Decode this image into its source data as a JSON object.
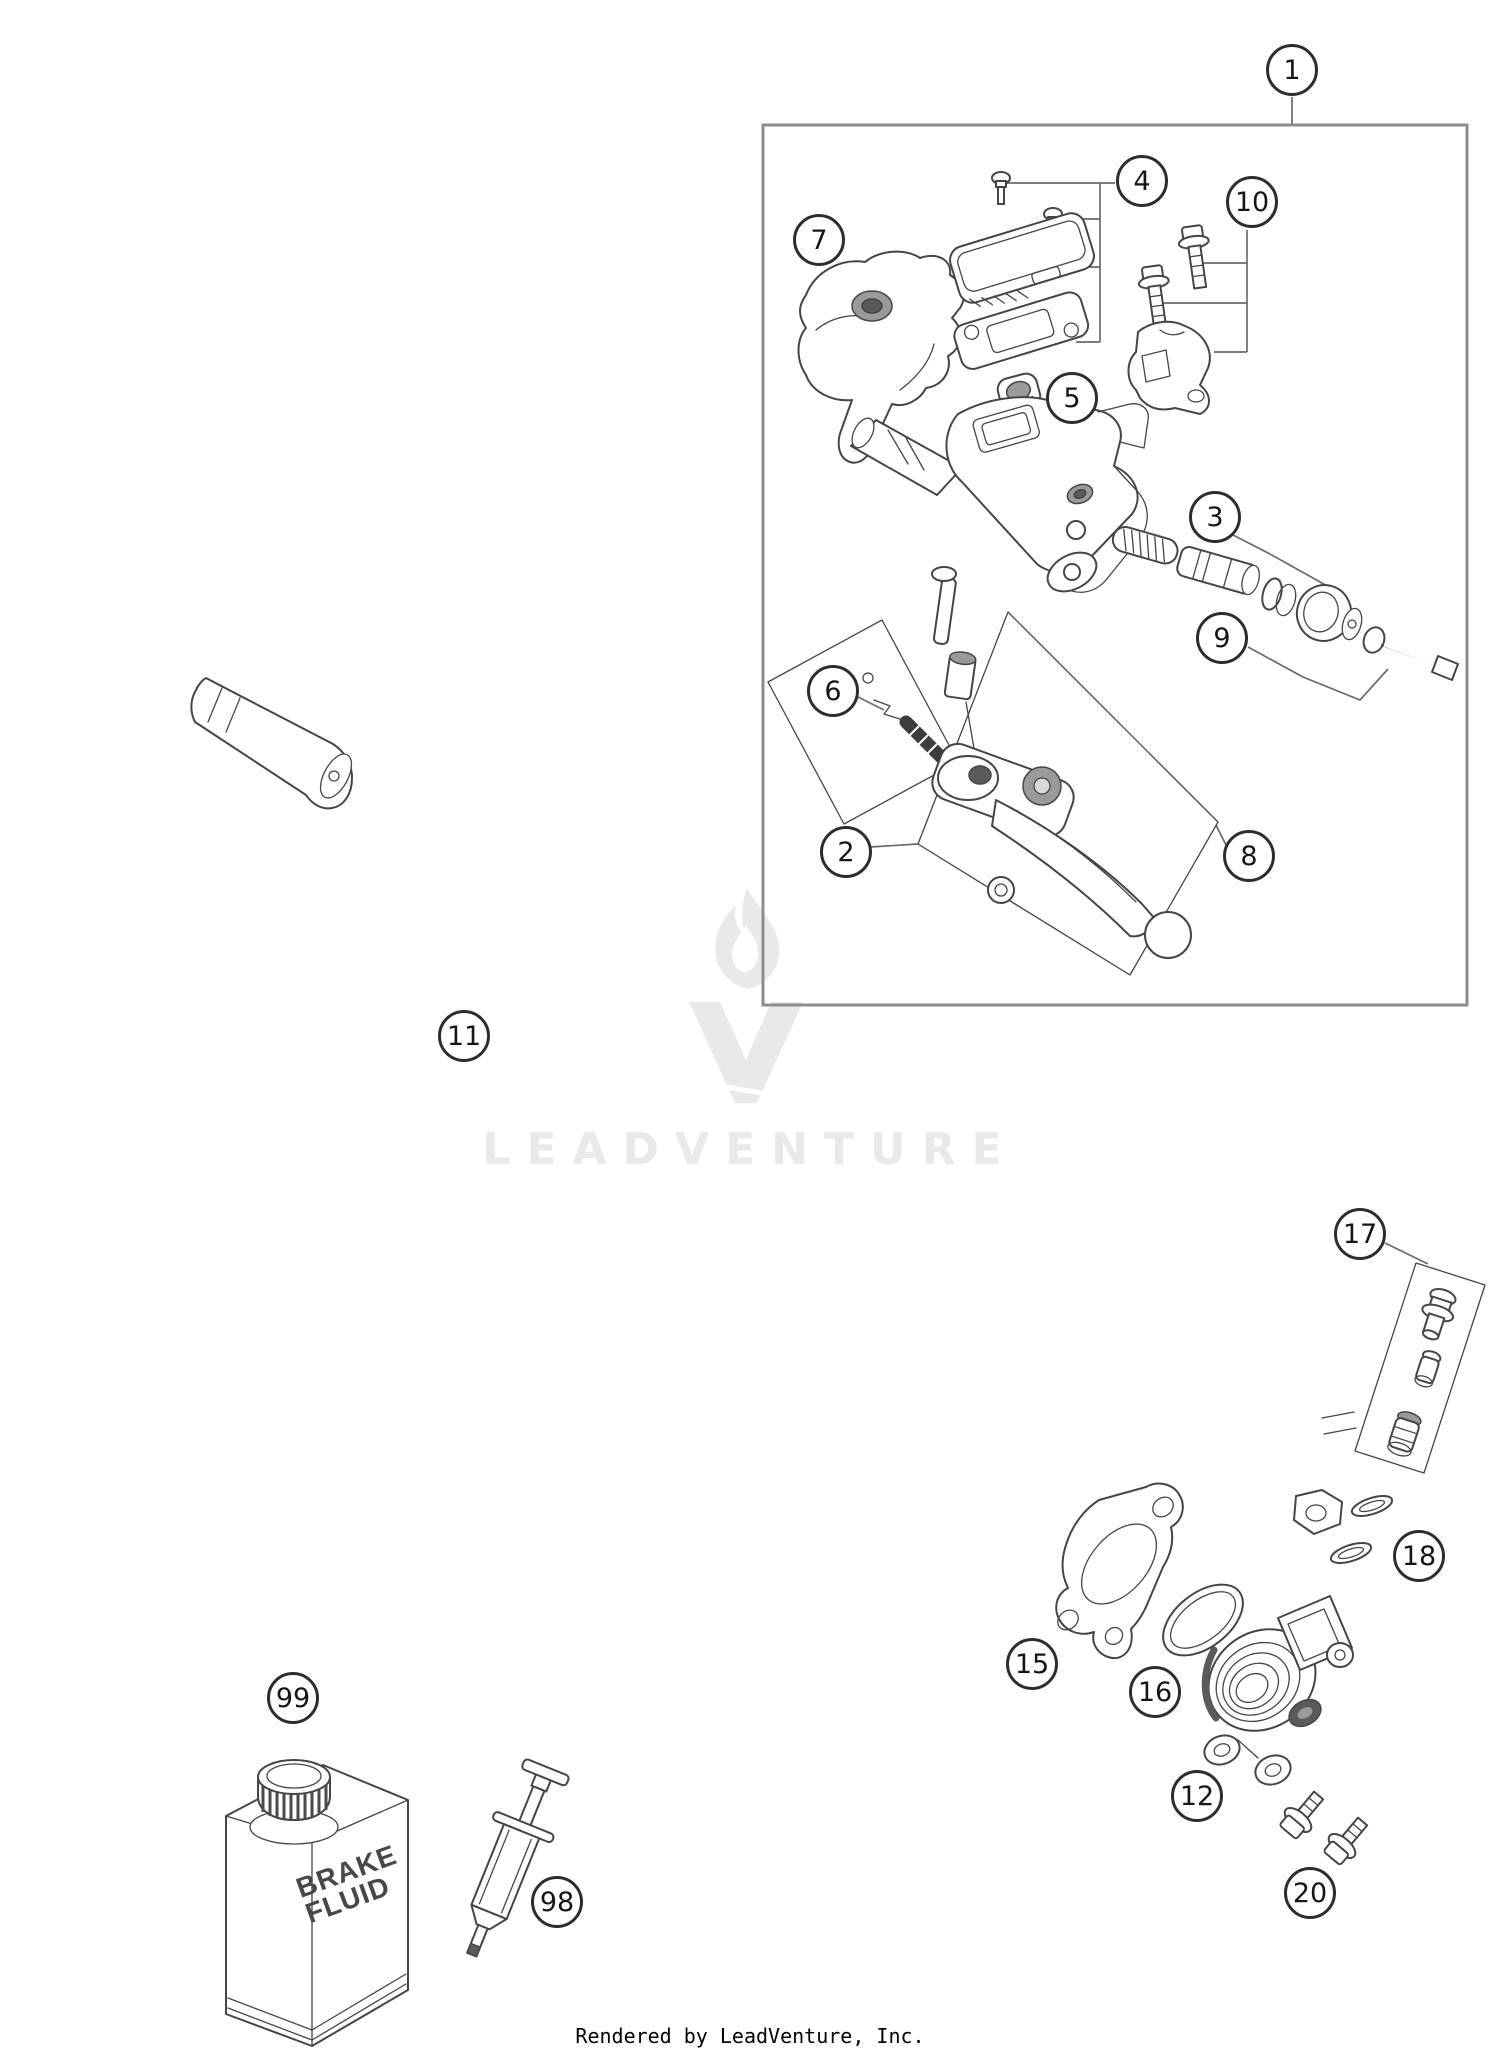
{
  "page": {
    "watermark_text": "LEADVENTURE",
    "footer": "Rendered by LeadVenture, Inc."
  },
  "bottle": {
    "label_line1": "BRAKE",
    "label_line2": "FLUID"
  },
  "colors": {
    "line": "#454545",
    "box_border": "#8c8c8c",
    "watermark": "#e9e9e9",
    "shade_dark": "#5a5a5a",
    "shade_mid": "#9a9a9a"
  },
  "callouts": [
    {
      "label": "1"
    },
    {
      "label": "2"
    },
    {
      "label": "3"
    },
    {
      "label": "4"
    },
    {
      "label": "5"
    },
    {
      "label": "6"
    },
    {
      "label": "7"
    },
    {
      "label": "8"
    },
    {
      "label": "9"
    },
    {
      "label": "10"
    },
    {
      "label": "11"
    },
    {
      "label": "12"
    },
    {
      "label": "15"
    },
    {
      "label": "16"
    },
    {
      "label": "17"
    },
    {
      "label": "18"
    },
    {
      "label": "20"
    },
    {
      "label": "98"
    },
    {
      "label": "99"
    }
  ]
}
